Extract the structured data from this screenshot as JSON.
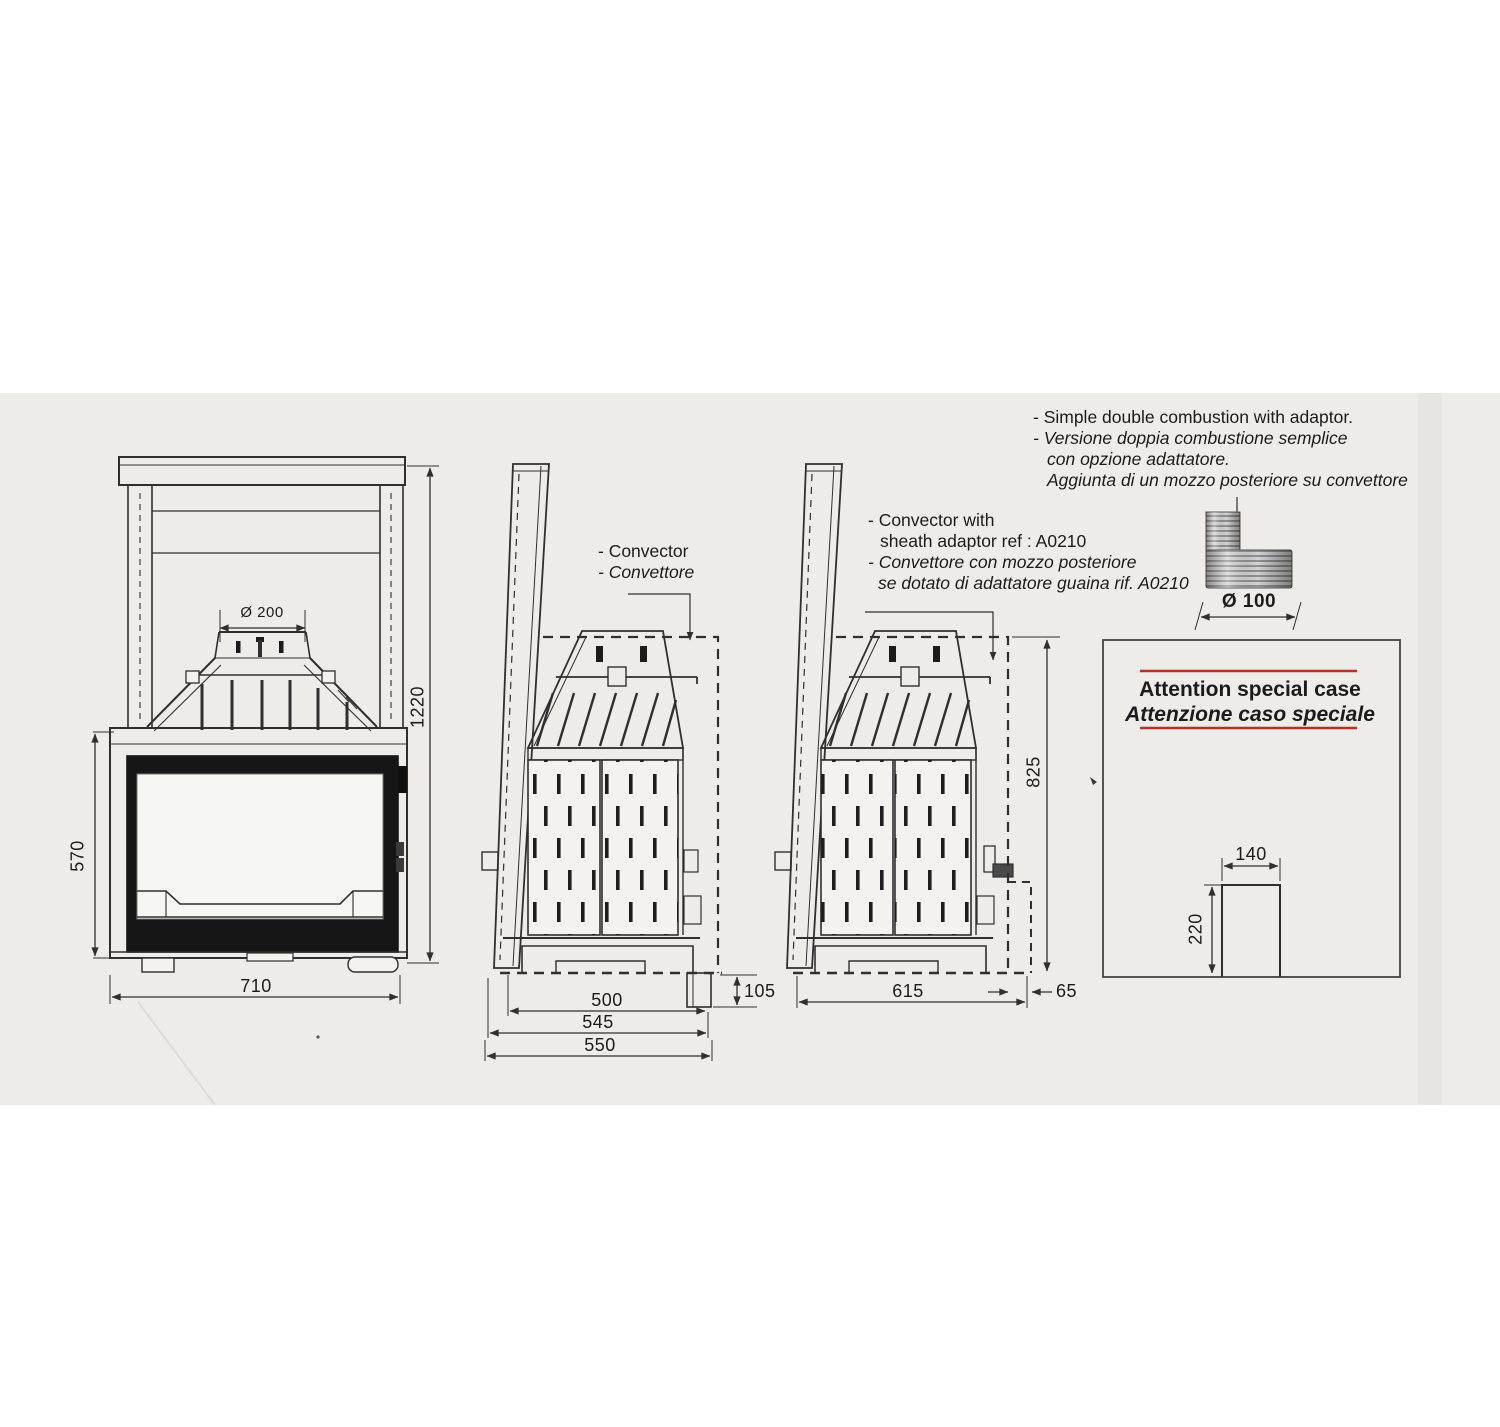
{
  "annotations": {
    "top_right": {
      "en": "- Simple double combustion with adaptor.",
      "it1": "- Versione doppia combustione semplice",
      "it2": "con opzione adattatore.",
      "it3": "Aggiunta di un mozzo posteriore su convettore"
    },
    "convector": {
      "en": "- Convector",
      "it": "- Convettore"
    },
    "sheath": {
      "en1": "- Convector with",
      "en2": "sheath adaptor ref : A0210",
      "it1": "- Convettore  con mozzo posteriore",
      "it2": "se dotato di adattatore guaina  rif. A0210"
    },
    "special_case": {
      "en": "Attention special case",
      "it": "Attenzione caso speciale"
    }
  },
  "dimensions": {
    "front_view": {
      "flue_diameter": "Ø 200",
      "total_height": "1220",
      "firebox_height": "570",
      "width": "710"
    },
    "side_view": {
      "body_depth": "500",
      "mid_depth": "545",
      "total_depth": "550",
      "rear_drop": "105"
    },
    "side_view_with_adaptor": {
      "height": "825",
      "depth": "615",
      "rear_offset": "65"
    },
    "special_case_duct": {
      "width": "140",
      "height": "220"
    },
    "adaptor": {
      "diameter": "Ø 100"
    }
  },
  "colors": {
    "accent_red": "#b52f25",
    "line": "#2f2f2f",
    "paper": "#edece8",
    "glass_frame": "#161616"
  }
}
